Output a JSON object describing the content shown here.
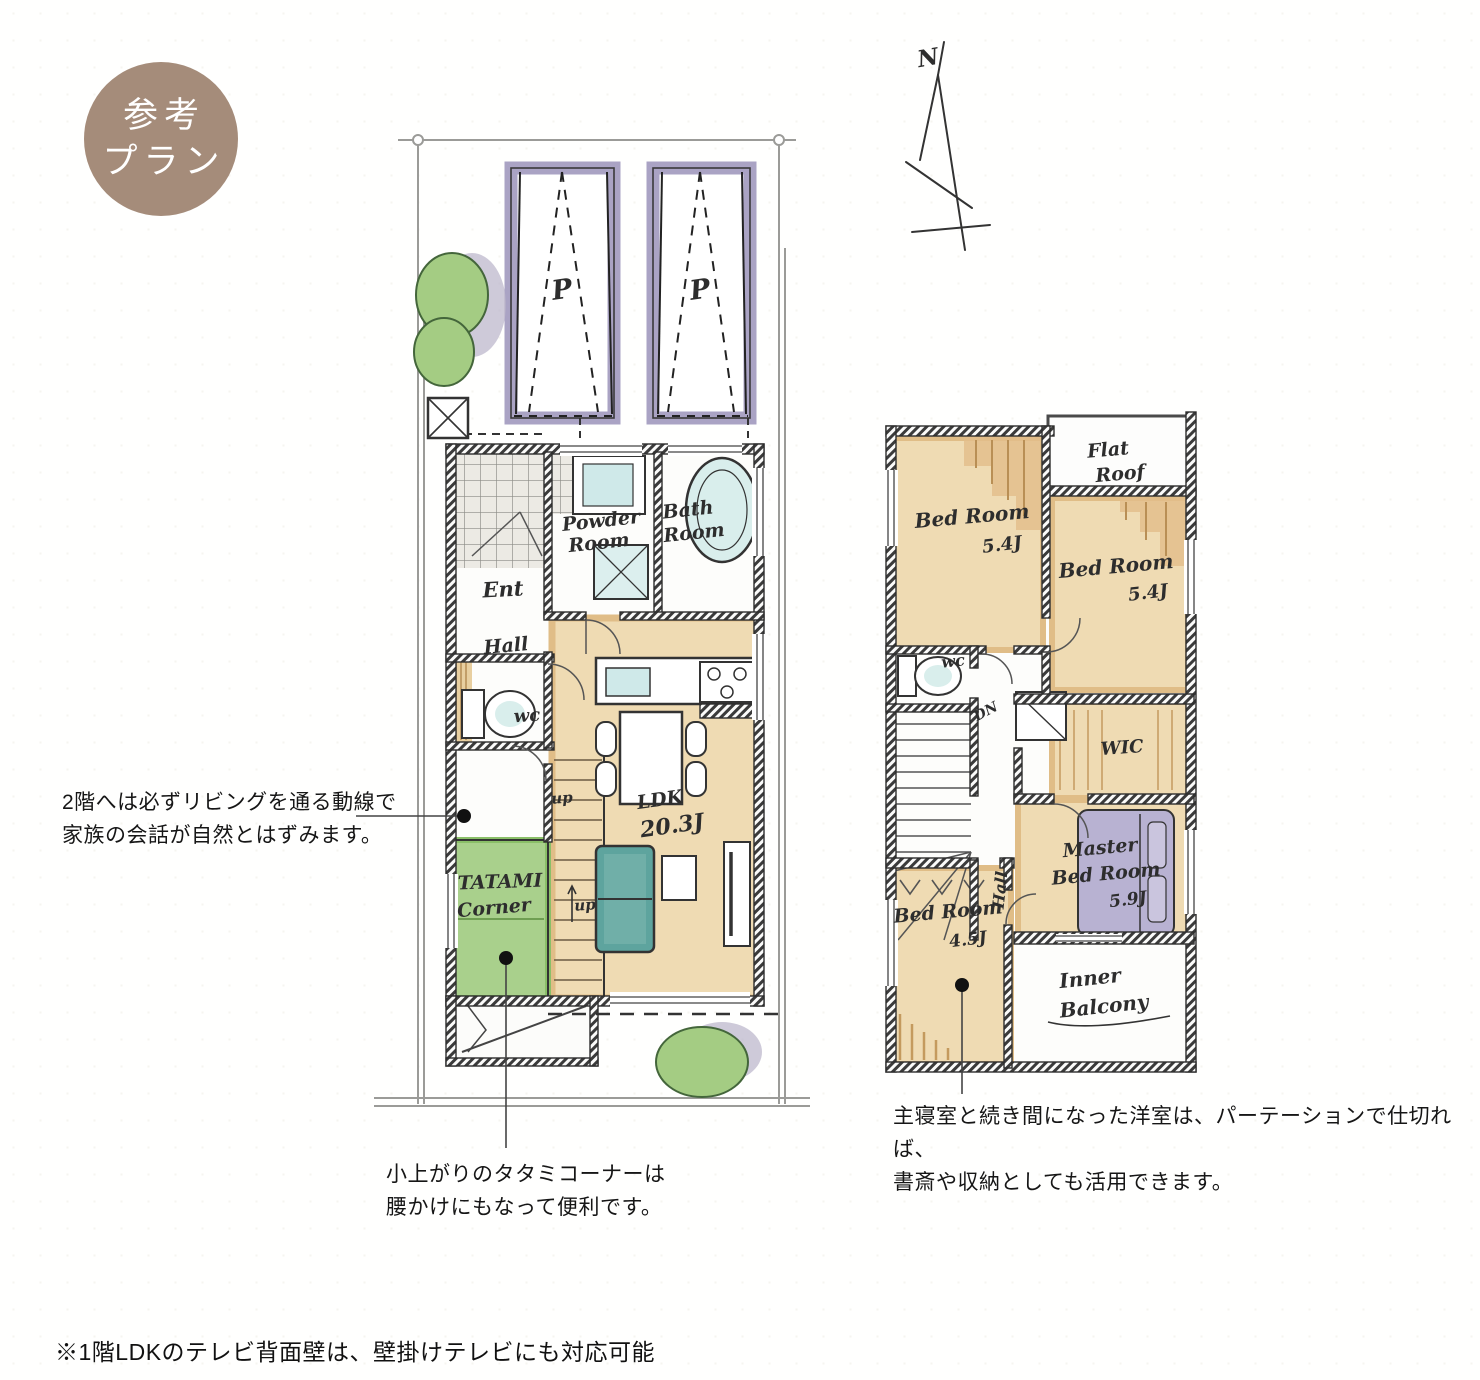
{
  "badge": {
    "line1": "参考",
    "line2": "プラン"
  },
  "compass": {
    "north": "N"
  },
  "floor1": {
    "parking_label": "P",
    "ent": "Ent",
    "hall": "Hall",
    "wc": "wc",
    "up": "up",
    "powder_1": "Powder",
    "powder_2": "Room",
    "bath_1": "Bath",
    "bath_2": "Room",
    "ldk": "LDK",
    "ldk_size": "20.3J",
    "tatami_1": "TATAMI",
    "tatami_2": "Corner"
  },
  "floor2": {
    "bedroom1": "Bed Room",
    "bedroom1_size": "5.4J",
    "bedroom2": "Bed Room",
    "bedroom2_size": "5.4J",
    "flat_roof_1": "Flat",
    "flat_roof_2": "Roof",
    "wc": "wc",
    "down": "DN",
    "hall": "Hall",
    "wic": "WIC",
    "master_1": "Master",
    "master_2": "Bed Room",
    "master_size": "5.9J",
    "bedroom3": "Bed Room",
    "bedroom3_size": "4.5J",
    "balcony_1": "Inner",
    "balcony_2": "Balcony"
  },
  "annotations": {
    "living_1": "2階へは必ずリビングを通る動線で",
    "living_2": "家族の会話が自然とはずみます。",
    "tatami_1": "小上がりのタタミコーナーは",
    "tatami_2": "腰かけにもなって便利です。",
    "master_1": "主寝室と続き間になった洋室は、パーテーションで仕切れば、",
    "master_2": "書斎や収納としても活用できます。"
  },
  "footer": {
    "note": "※1階LDKのテレビ背面壁は、壁掛けテレビにも対応可能"
  },
  "colors": {
    "badge": "#a58c7a",
    "tan": "#efdbb3",
    "tatami_green": "#a9d08c",
    "sofa_teal": "#5ea49e",
    "parking_purple": "#aaa3c4",
    "bed_lavender": "#b8b2d2",
    "bath_blue": "#d9eeec",
    "wall": "#3a3a3a"
  }
}
